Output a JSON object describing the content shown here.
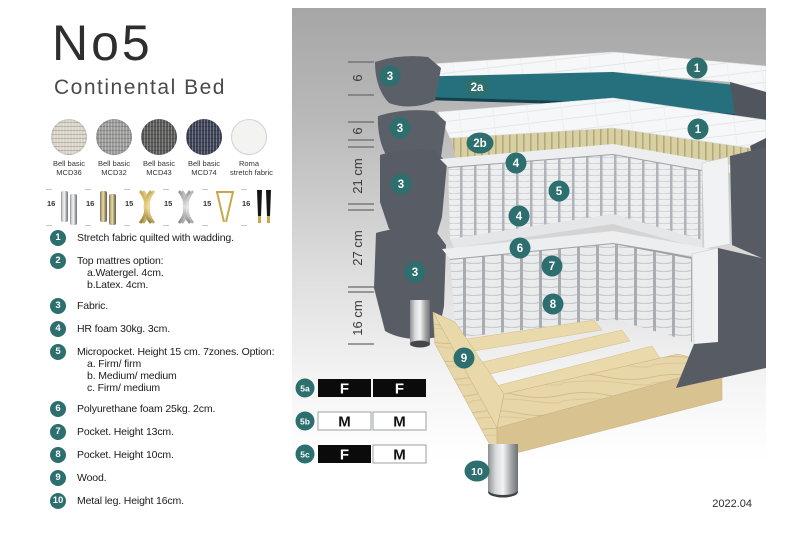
{
  "title": "No5",
  "subtitle": "Continental Bed",
  "swatches": [
    {
      "line1": "Bell basic",
      "line2": "MCD36",
      "color": "#d9d4c8"
    },
    {
      "line1": "Bell basic",
      "line2": "MCD32",
      "color": "#9c9c9a"
    },
    {
      "line1": "Bell basic",
      "line2": "MCD43",
      "color": "#595a58"
    },
    {
      "line1": "Bell basic",
      "line2": "MCD74",
      "color": "#3d4257"
    },
    {
      "line1": "Roma",
      "line2": "stretch fabric",
      "color": "#f3f3f1"
    }
  ],
  "legs": [
    {
      "size": "16",
      "type": "chrome-cylinder-legs"
    },
    {
      "size": "16",
      "type": "bronze-cylinder-legs"
    },
    {
      "size": "15",
      "type": "gold-cross-legs"
    },
    {
      "size": "15",
      "type": "silver-cross-legs"
    },
    {
      "size": "15",
      "type": "gold-hairpin-leg"
    },
    {
      "size": "16",
      "type": "black-gold-tip-legs"
    }
  ],
  "list": [
    {
      "num": "1",
      "text": "Stretch fabric quilted with wadding.",
      "sub": []
    },
    {
      "num": "2",
      "text": "Top mattres option:",
      "sub": [
        "a.Watergel. 4cm.",
        "b.Latex. 4cm."
      ]
    },
    {
      "num": "3",
      "text": "Fabric.",
      "sub": []
    },
    {
      "num": "4",
      "text": "HR foam 30kg. 3cm.",
      "sub": []
    },
    {
      "num": "5",
      "text": "Micropocket. Height 15 cm. 7zones. Option:",
      "sub": [
        "a. Firm/ firm",
        "b. Medium/ medium",
        "c. Firm/ medium"
      ]
    },
    {
      "num": "6",
      "text": "Polyurethane foam 25kg. 2cm.",
      "sub": []
    },
    {
      "num": "7",
      "text": "Pocket. Height 13cm.",
      "sub": []
    },
    {
      "num": "8",
      "text": "Pocket. Height 10cm.",
      "sub": []
    },
    {
      "num": "9",
      "text": "Wood.",
      "sub": []
    },
    {
      "num": "10",
      "text": "Metal leg. Height 16cm.",
      "sub": []
    }
  ],
  "diagram": {
    "measurements": [
      "6",
      "6",
      "21 cm",
      "27 cm",
      "16 cm"
    ],
    "badges": {
      "one": "1",
      "two_a": "2a",
      "two_b": "2b",
      "three": "3",
      "four": "4",
      "five": "5",
      "six": "6",
      "seven": "7",
      "eight": "8",
      "nine": "9",
      "ten": "10"
    },
    "firmness_table": [
      {
        "label": "5a",
        "cells": [
          {
            "text": "F",
            "style": "dark"
          },
          {
            "text": "F",
            "style": "dark"
          }
        ]
      },
      {
        "label": "5b",
        "cells": [
          {
            "text": "M",
            "style": "light"
          },
          {
            "text": "M",
            "style": "light"
          }
        ]
      },
      {
        "label": "5c",
        "cells": [
          {
            "text": "F",
            "style": "dark"
          },
          {
            "text": "M",
            "style": "light"
          }
        ]
      }
    ],
    "version": "2022.04",
    "colors": {
      "badge_teal": "#2c6f6e",
      "topper_teal": "#26707e",
      "fabric_gray": "#5a5f68",
      "latex_beige": "#d8d0a2",
      "wood": "#e7d6a8"
    }
  }
}
